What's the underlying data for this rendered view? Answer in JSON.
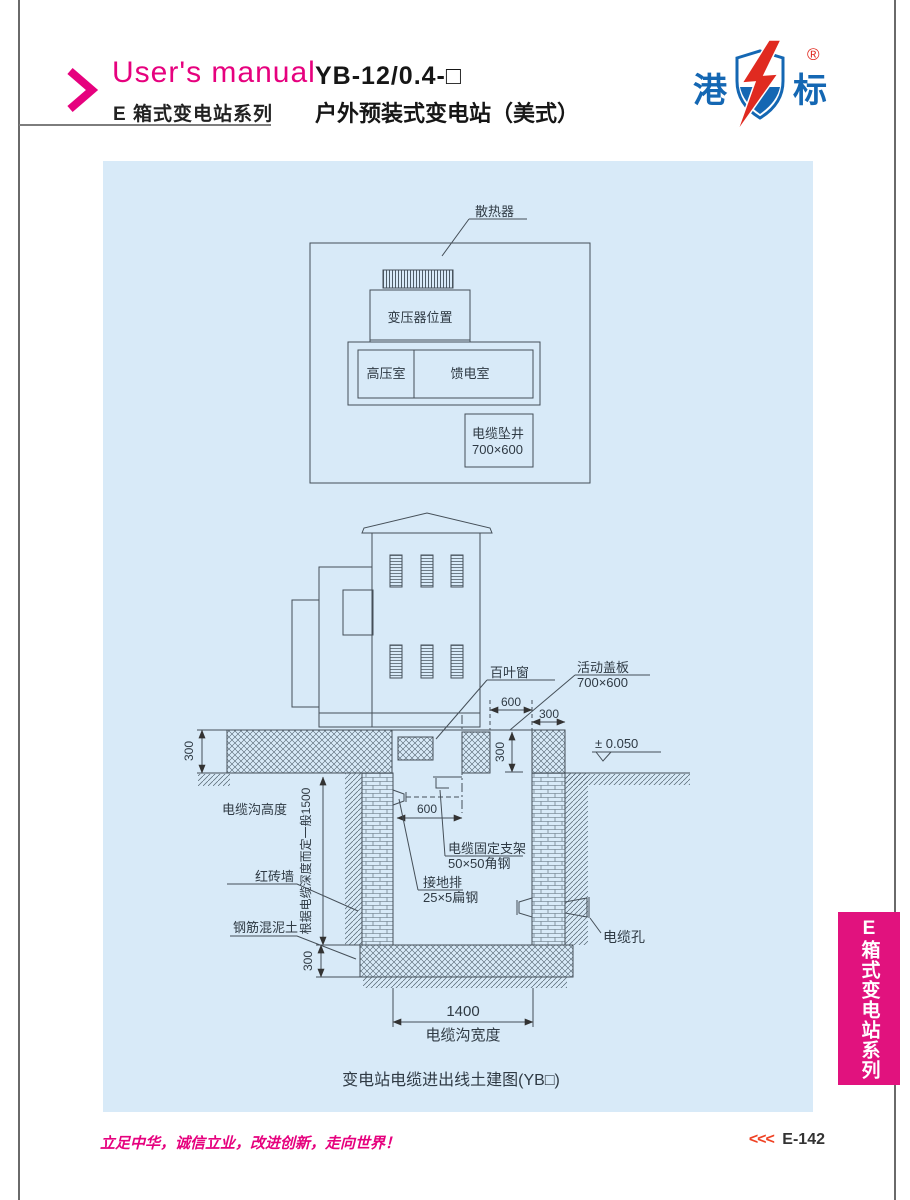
{
  "header": {
    "brand": "User's manual",
    "series": "E 箱式变电站系列",
    "model": "YB-12/0.4-□",
    "product_name": "户外预装式变电站（美式）"
  },
  "logo": {
    "char_left": "港",
    "char_right": "标",
    "registered_mark": "®"
  },
  "plan_view": {
    "radiator": "散热器",
    "transformer_position": "变压器位置",
    "hv_room": "高压室",
    "feeder_room": "馈电室",
    "cable_shaft": "电缆坠井",
    "cable_shaft_size": "700×600"
  },
  "section_view": {
    "louver": "百叶窗",
    "cover_plate": "活动盖板",
    "cover_plate_size": "700×600",
    "level_mark": "± 0.050",
    "dim_cover_width": "600",
    "dim_edge": "300",
    "dim_slab_left": "300",
    "dim_shaft_depth": "300",
    "trench_height_label": "电缆沟高度",
    "depth_note": "根据电缆深度而定一般1500",
    "brick_wall": "红砖墙",
    "concrete": "钢筋混泥土",
    "dim_bracket_spacing": "600",
    "bracket": "电缆固定支架",
    "bracket_size": "50×50角钢",
    "ground_bar": "接地排",
    "ground_bar_size": "25×5扁钢",
    "cable_hole": "电缆孔",
    "dim_bottom": "300",
    "dim_trench_width": "1400",
    "trench_width_label": "电缆沟宽度"
  },
  "caption": "变电站电缆进出线土建图(YB□)",
  "sidebar_tab": "E箱式变电站系列",
  "footer": {
    "slogan": "立足中华，诚信立业，改进创新，走向世界！",
    "page_marker": "<<<",
    "page_number": "E-142"
  }
}
